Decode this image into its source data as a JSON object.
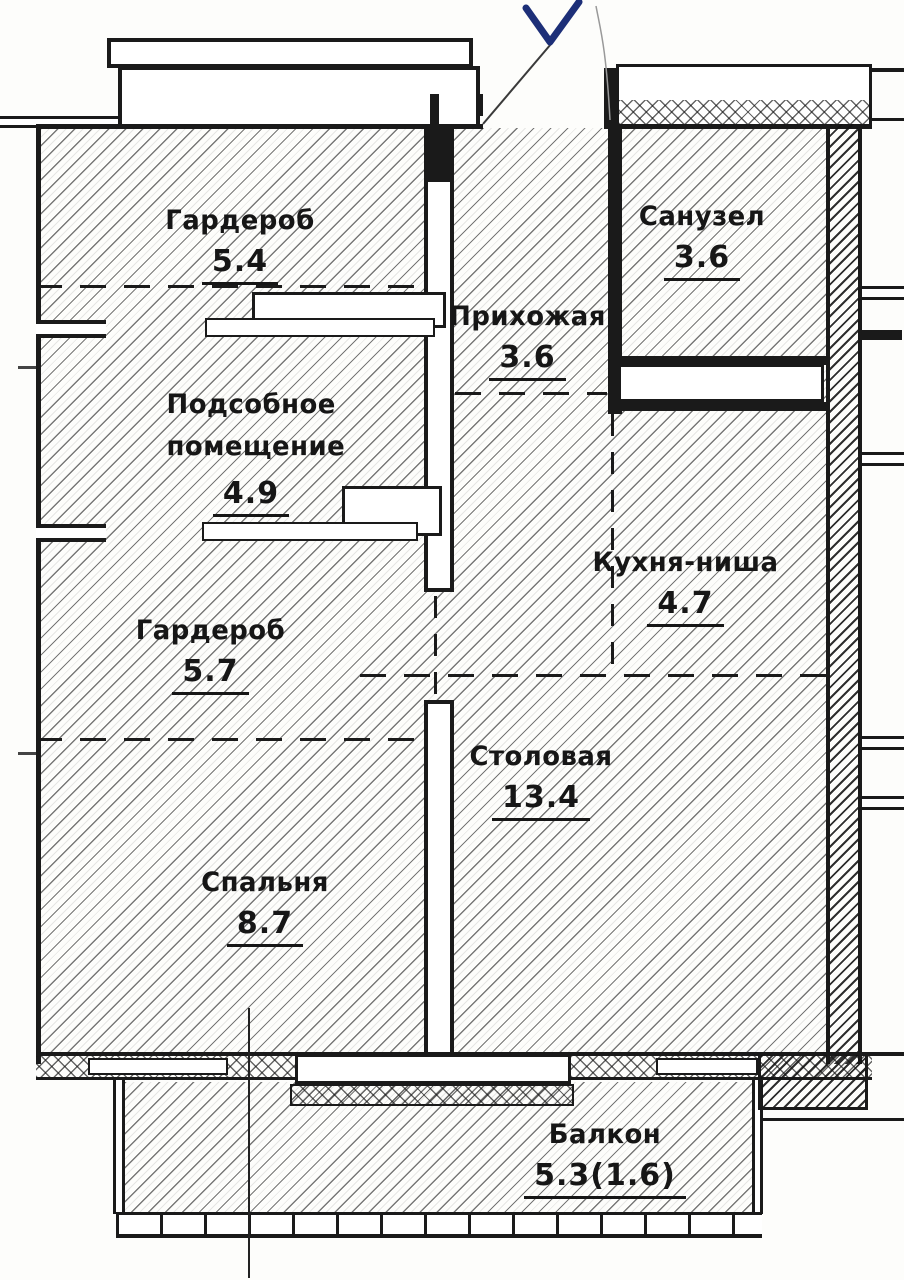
{
  "rooms": [
    {
      "id": "garderob-top",
      "name": "Гардероб",
      "area": "5.4"
    },
    {
      "id": "sanuzel",
      "name": "Санузел",
      "area": "3.6"
    },
    {
      "id": "prihozhaya",
      "name": "Прихожая",
      "area": "3.6"
    },
    {
      "id": "podsobnoe",
      "name": "Подсобное помещение",
      "area": "4.9"
    },
    {
      "id": "kuhnya-nisha",
      "name": "Кухня-ниша",
      "area": "4.7"
    },
    {
      "id": "garderob-mid",
      "name": "Гардероб",
      "area": "5.7"
    },
    {
      "id": "stolovaya",
      "name": "Столовая",
      "area": "13.4"
    },
    {
      "id": "spalnya",
      "name": "Спальня",
      "area": "8.7"
    },
    {
      "id": "balkon",
      "name": "Балкон",
      "area": "5.3(1.6)"
    }
  ],
  "annotations": {
    "checkmark_color": "#1d2f78"
  },
  "colors": {
    "ink": "#1a1a1a",
    "paper": "#fdfdfb"
  }
}
